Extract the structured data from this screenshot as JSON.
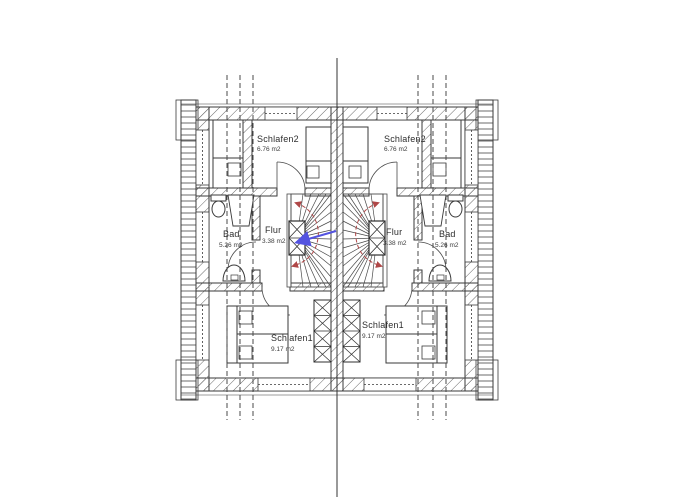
{
  "drawing": {
    "units": {
      "left": {
        "rooms": [
          {
            "name": "Schlafen2",
            "area": "6.76 m2"
          },
          {
            "name": "Bad",
            "area": "5.26 m2"
          },
          {
            "name": "Flur",
            "area": "3.38 m2"
          },
          {
            "name": "Schlafen1",
            "area": "9.17 m2"
          }
        ]
      },
      "right": {
        "rooms": [
          {
            "name": "Schlafen2",
            "area": "6.76 m2"
          },
          {
            "name": "Bad",
            "area": "5.26 m2"
          },
          {
            "name": "Flur",
            "area": "3.38 m2"
          },
          {
            "name": "Schlafen1",
            "area": "9.17 m2"
          }
        ]
      }
    },
    "colors": {
      "line": "#3a3a3a",
      "walk_line_red": "#b04848",
      "pointer_blue": "#5353e0",
      "background": "#ffffff"
    }
  }
}
